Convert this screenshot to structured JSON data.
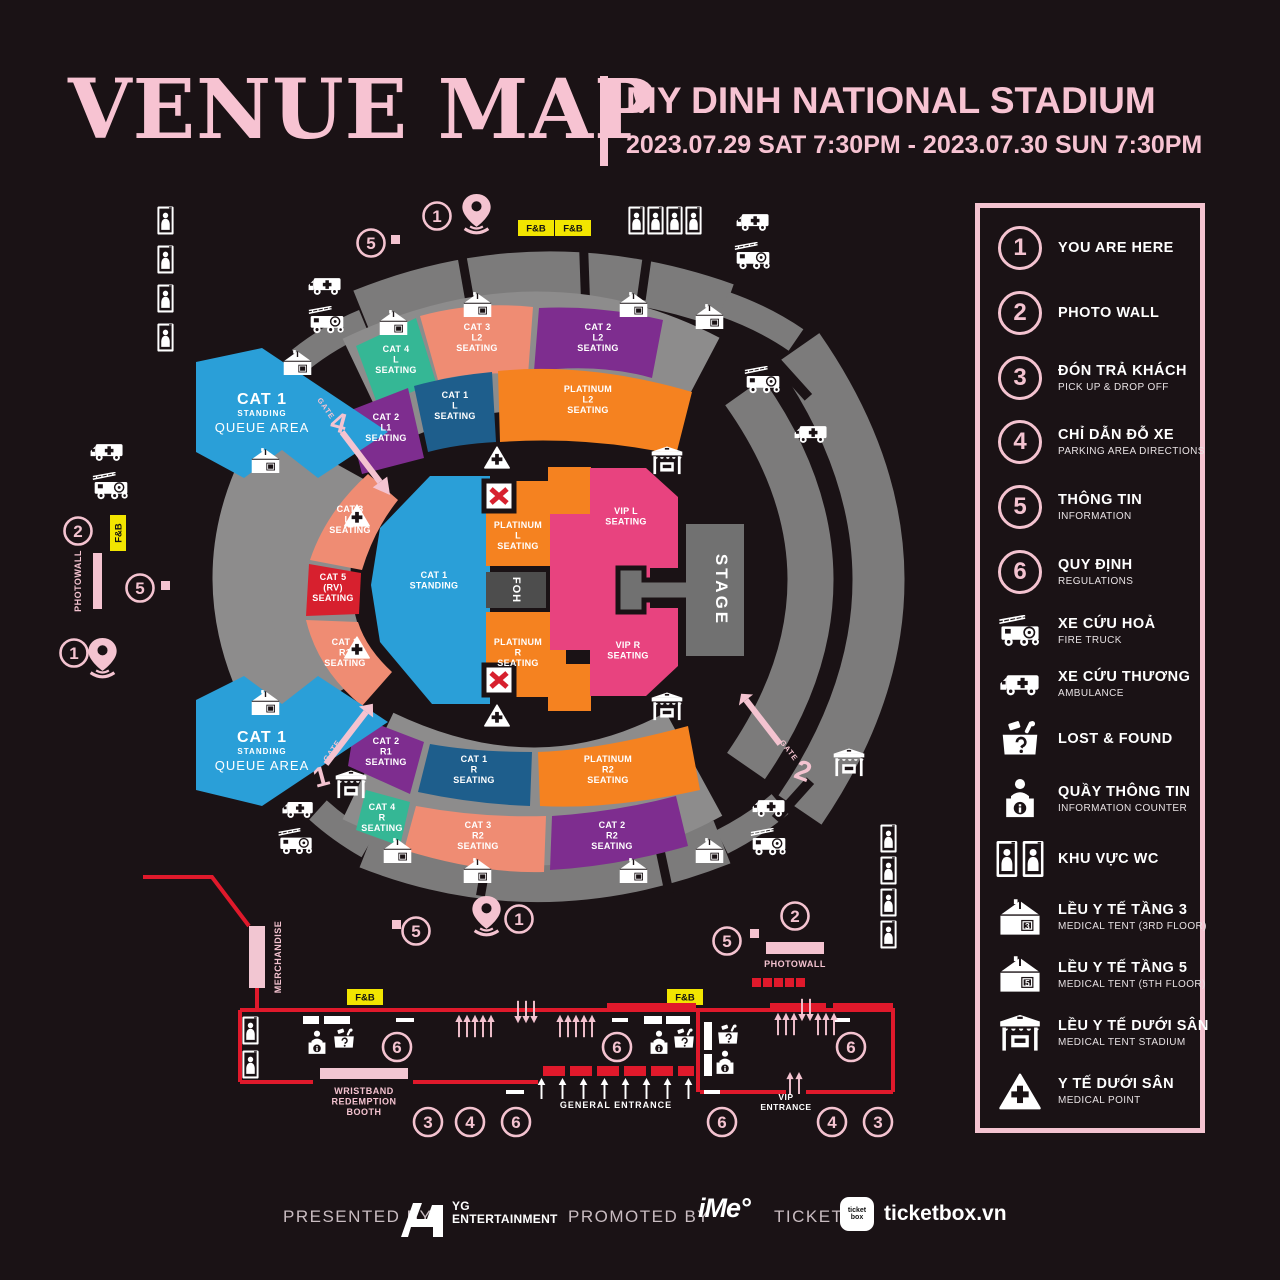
{
  "title": "VENUE MAP",
  "venue": "MY DINH NATIONAL STADIUM",
  "datetime": "2023.07.29 SAT 7:30PM - 2023.07.30 SUN 7:30PM",
  "colors": {
    "background": "#1a1215",
    "pink": "#f4c3d0",
    "red": "#e0192b",
    "yellow": "#f2e500",
    "gray_ring": "#7c7b7b",
    "gray_platform": "#8d8c8c",
    "cat1_standing": "#2a9fd8",
    "cat1_seating": "#1e5e8c",
    "cat2": "#7e2d8f",
    "cat3": "#ef8c73",
    "cat4": "#35b795",
    "cat5": "#d7202e",
    "platinum": "#f58220",
    "vip": "#e8437f",
    "stage": "#717171",
    "foh": "#4d4d4d",
    "white": "#ffffff"
  },
  "legend": {
    "items": [
      {
        "num": "1",
        "title": "YOU ARE HERE",
        "subtitle": ""
      },
      {
        "num": "2",
        "title": "PHOTO WALL",
        "subtitle": ""
      },
      {
        "num": "3",
        "title": "ĐÓN TRẢ KHÁCH",
        "subtitle": "PICK UP & DROP OFF"
      },
      {
        "num": "4",
        "title": "CHỈ DẪN ĐỖ XE",
        "subtitle": "PARKING AREA DIRECTIONS"
      },
      {
        "num": "5",
        "title": "THÔNG TIN",
        "subtitle": "INFORMATION"
      },
      {
        "num": "6",
        "title": "QUY ĐỊNH",
        "subtitle": "REGULATIONS"
      },
      {
        "icon": "fire-truck",
        "title": "XE CỨU HOẢ",
        "subtitle": "FIRE TRUCK"
      },
      {
        "icon": "ambulance",
        "title": "XE CỨU THƯƠNG",
        "subtitle": "AMBULANCE"
      },
      {
        "icon": "lost-found",
        "title": "LOST & FOUND",
        "subtitle": ""
      },
      {
        "icon": "information-counter",
        "title": "QUẦY THÔNG TIN",
        "subtitle": "INFORMATION COUNTER"
      },
      {
        "icon": "wc",
        "title": "KHU VỰC WC",
        "subtitle": ""
      },
      {
        "icon": "medical-tent",
        "badge": "3",
        "title": "LỀU Y TẾ TẦNG 3",
        "subtitle": "MEDICAL TENT  (3RD FLOOR)"
      },
      {
        "icon": "medical-tent",
        "badge": "5",
        "title": "LỀU Y TẾ TẦNG 5",
        "subtitle": "MEDICAL TENT  (5TH FLOOR)"
      },
      {
        "icon": "medical-tent-stadium",
        "title": "LỀU Y TẾ DƯỚI SÂN",
        "subtitle": "MEDICAL TENT STADIUM"
      },
      {
        "icon": "medical-point",
        "title": "Y TẾ DƯỚI SÂN",
        "subtitle": "MEDICAL POINT"
      }
    ]
  },
  "map": {
    "stage": "STAGE",
    "foh": "FOH",
    "fnb": "F&B",
    "merchandise": "MERCHANDISE",
    "photowall": "PHOTOWALL",
    "wristband": "WRISTBAND\nREDEMPTION\nBOOTH",
    "general_entrance": "GENERAL ENTRANCE",
    "vip_entrance": "VIP\nENTRANCE",
    "queue": {
      "line1": "CAT 1",
      "line2": "STANDING",
      "line3": "QUEUE AREA"
    },
    "gates": {
      "word": "GATE",
      "g1": "1",
      "g2": "2",
      "g4": "4"
    },
    "nums": {
      "n1": "1",
      "n2": "2",
      "n3": "3",
      "n4": "4",
      "n5": "5",
      "n6": "6"
    },
    "sections": {
      "cat4_l": "CAT 4\nL\nSEATING",
      "cat3_l2": "CAT 3\nL2\nSEATING",
      "cat2_l2": "CAT 2\nL2\nSEATING",
      "cat2_l1": "CAT 2\nL1\nSEATING",
      "cat1_l": "CAT 1\nL\nSEATING",
      "platinum_l2": "PLATINUM\nL2\nSEATING",
      "cat3_l1": "CAT 3\nL1\nSEATING",
      "cat5_rv": "CAT 5\n(RV)\nSEATING",
      "cat3_r1": "CAT 3\nR1\nSEATING",
      "cat2_r1": "CAT 2\nR1\nSEATING",
      "cat1_r": "CAT 1\nR\nSEATING",
      "platinum_r2": "PLATINUM\nR2\nSEATING",
      "cat4_r": "CAT 4\nR\nSEATING",
      "cat3_r2": "CAT 3\nR2\nSEATING",
      "cat2_r2": "CAT 2\nR2\nSEATING",
      "cat1_standing": "CAT 1\nSTANDING",
      "platinum_l": "PLATINUM\nL\nSEATING",
      "platinum_r": "PLATINUM\nR\nSEATING",
      "vip_l": "VIP L\nSEATING",
      "vip_r": "VIP R\nSEATING"
    }
  },
  "footer": {
    "presented": "PRESENTED BY",
    "yg_line1": "YG",
    "yg_line2": "ENTERTAINMENT",
    "promoted": "PROMOTED BY",
    "ime": "iMe°",
    "ticket": "TICKET",
    "tb_line1": "ticket",
    "tb_line2": "box",
    "ticketbox": "ticketbox.vn"
  }
}
